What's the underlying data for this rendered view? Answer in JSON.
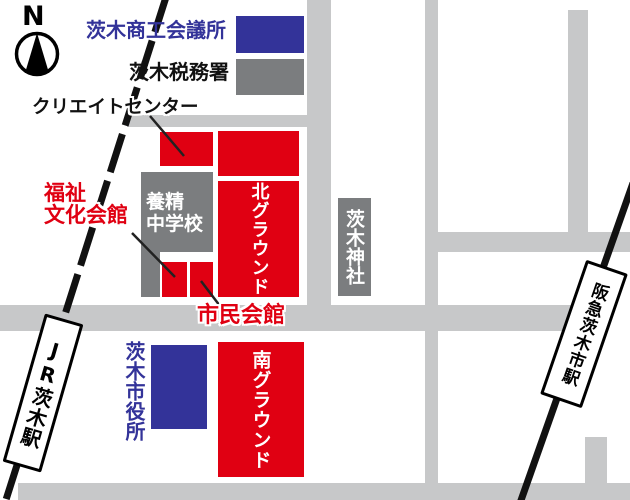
{
  "compass": {
    "label": "N"
  },
  "legend": [
    {
      "label": "茨木商工会議所",
      "swatch_color": "#333399"
    },
    {
      "label": "茨木税務署",
      "swatch_color": "#7B7D7F"
    }
  ],
  "labels": {
    "create_center": "クリエイトセンター",
    "welfare_line1": "福祉",
    "welfare_line2": "文化会館",
    "civic_hall": "市民会館",
    "city_hall": "茨木市役所"
  },
  "buildings": {
    "school_line1": "養精",
    "school_line2": "中学校",
    "north_ground": "北グラウンド",
    "south_ground": "南グラウンド",
    "shrine": "茨木神社"
  },
  "stations": {
    "jr": "JR茨木駅",
    "hankyu": "阪急茨木市駅"
  },
  "colors": {
    "red": "#E00012",
    "blue": "#333399",
    "building-gray": "#7B7D7F",
    "road-gray": "#C7C8C9",
    "rail-black": "#111111"
  }
}
